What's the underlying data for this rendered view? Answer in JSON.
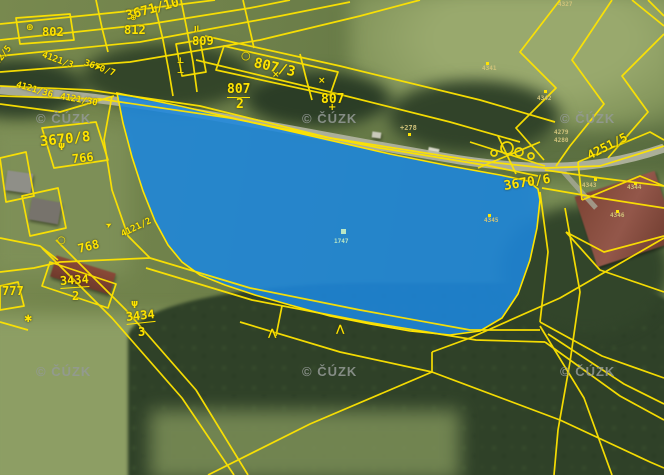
{
  "map": {
    "watermark_text": "© ČÚZK",
    "colors": {
      "boundary_line": "#ffe400",
      "highlight_fill": "#1c86dd",
      "watermark": "#949a96",
      "label": "#ffe400",
      "tiny_label": "#cfc27a",
      "tiny_label_light": "#b9e6c4"
    },
    "highlight": {
      "fill": "#1c86dd",
      "opacity": 0.88,
      "stroke": "#ffe400"
    },
    "watermarks": [
      {
        "x": 36,
        "y": 111
      },
      {
        "x": 302,
        "y": 111
      },
      {
        "x": 560,
        "y": 111
      },
      {
        "x": 36,
        "y": 364
      },
      {
        "x": 302,
        "y": 364
      },
      {
        "x": 560,
        "y": 364
      }
    ],
    "parcel_labels": [
      {
        "t": "802",
        "x": 42,
        "y": 26,
        "r": 0,
        "s": 12
      },
      {
        "t": "812",
        "x": 124,
        "y": 24,
        "r": 0,
        "s": 12
      },
      {
        "t": "809",
        "x": 192,
        "y": 35,
        "r": 0,
        "s": 12
      },
      {
        "t": "3671/10",
        "x": 126,
        "y": 10,
        "r": -15,
        "s": 13
      },
      {
        "t": "807/3",
        "x": 254,
        "y": 56,
        "r": 13,
        "s": 14
      },
      {
        "t": "807",
        "x": 227,
        "y": 83,
        "r": 0,
        "s": 13,
        "u": true
      },
      {
        "t": "2",
        "x": 236,
        "y": 98,
        "r": 0,
        "s": 13
      },
      {
        "t": "807",
        "x": 321,
        "y": 93,
        "r": 0,
        "s": 13
      },
      {
        "t": "3670/7",
        "x": 84,
        "y": 59,
        "r": 20,
        "s": 9
      },
      {
        "t": "4121/3",
        "x": 42,
        "y": 51,
        "r": 20,
        "s": 9
      },
      {
        "t": "02/5",
        "x": -3,
        "y": 60,
        "r": -52,
        "s": 9
      },
      {
        "t": "4121/36",
        "x": 16,
        "y": 81,
        "r": 16,
        "s": 9
      },
      {
        "t": "4121/30",
        "x": 60,
        "y": 93,
        "r": 10,
        "s": 9
      },
      {
        "t": "3670/8",
        "x": 40,
        "y": 135,
        "r": -6,
        "s": 14
      },
      {
        "t": "3670/6",
        "x": 504,
        "y": 180,
        "r": -9,
        "s": 13
      },
      {
        "t": "4251/5",
        "x": 588,
        "y": 150,
        "r": -27,
        "s": 12
      },
      {
        "t": "766",
        "x": 72,
        "y": 153,
        "r": -6,
        "s": 12
      },
      {
        "t": "768",
        "x": 78,
        "y": 243,
        "r": -14,
        "s": 12
      },
      {
        "t": "4121/2",
        "x": 122,
        "y": 231,
        "r": -26,
        "s": 9
      },
      {
        "t": "777",
        "x": 2,
        "y": 285,
        "r": 0,
        "s": 12
      },
      {
        "t": "3434",
        "x": 60,
        "y": 275,
        "r": -4,
        "s": 12,
        "u": true
      },
      {
        "t": "2",
        "x": 72,
        "y": 290,
        "r": 0,
        "s": 12
      },
      {
        "t": "3434",
        "x": 126,
        "y": 311,
        "r": -6,
        "s": 12,
        "u": true
      },
      {
        "t": "3",
        "x": 138,
        "y": 326,
        "r": 0,
        "s": 12
      }
    ],
    "point_labels": [
      {
        "t": "4341",
        "x": 482,
        "y": 66,
        "s": 6
      },
      {
        "t": "4342",
        "x": 537,
        "y": 96,
        "s": 6
      },
      {
        "t": "4343",
        "x": 582,
        "y": 183,
        "s": 6
      },
      {
        "t": "4344",
        "x": 627,
        "y": 185,
        "s": 6
      },
      {
        "t": "4345",
        "x": 484,
        "y": 218,
        "s": 6
      },
      {
        "t": "4346",
        "x": 610,
        "y": 213,
        "s": 6
      },
      {
        "t": "4279",
        "x": 554,
        "y": 130,
        "s": 6
      },
      {
        "t": "4280",
        "x": 554,
        "y": 138,
        "s": 6
      },
      {
        "t": "+278",
        "x": 400,
        "y": 125,
        "s": 7
      },
      {
        "t": "4327",
        "x": 558,
        "y": 2,
        "s": 6
      },
      {
        "t": "1747",
        "x": 334,
        "y": 239,
        "s": 6,
        "light": true
      }
    ],
    "symbols": [
      {
        "g": "⊕",
        "x": 26,
        "y": 24,
        "s": 9,
        "r": 0
      },
      {
        "g": "⊕",
        "x": 130,
        "y": 14,
        "s": 8,
        "r": 0
      },
      {
        "g": "○",
        "x": 241,
        "y": 50,
        "s": 11,
        "r": 0
      },
      {
        "g": "○",
        "x": 57,
        "y": 236,
        "s": 10,
        "r": 0
      },
      {
        "g": "ψ",
        "x": 58,
        "y": 142,
        "s": 9,
        "r": 0
      },
      {
        "g": "ψ",
        "x": 131,
        "y": 300,
        "s": 9,
        "r": 0
      },
      {
        "g": "➤",
        "x": 94,
        "y": 63,
        "s": 9,
        "r": 12
      },
      {
        "g": "➤",
        "x": 106,
        "y": 223,
        "s": 8,
        "r": -28
      },
      {
        "g": "✱",
        "x": 24,
        "y": 315,
        "s": 10,
        "r": 0
      },
      {
        "g": "⋀",
        "x": 268,
        "y": 329,
        "s": 10,
        "r": 0
      },
      {
        "g": "⋀",
        "x": 336,
        "y": 325,
        "s": 10,
        "r": 0
      },
      {
        "g": "+",
        "x": 328,
        "y": 103,
        "s": 10,
        "r": 0
      },
      {
        "g": "×",
        "x": 272,
        "y": 71,
        "s": 9,
        "r": 0
      },
      {
        "g": "×",
        "x": 318,
        "y": 77,
        "s": 9,
        "r": 0
      },
      {
        "g": "Jl",
        "x": 194,
        "y": 26,
        "s": 7,
        "r": 0
      },
      {
        "g": "⊥",
        "x": 177,
        "y": 57,
        "s": 8,
        "r": 0
      },
      {
        "g": "⊥",
        "x": 177,
        "y": 67,
        "s": 8,
        "r": 0
      }
    ]
  }
}
